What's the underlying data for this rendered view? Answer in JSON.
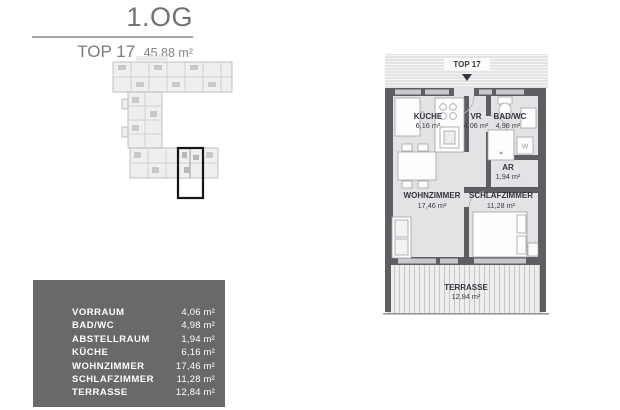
{
  "header": {
    "floor_label": "1.OG",
    "unit_label": "TOP 17",
    "total_area": "45,88 m²"
  },
  "plan": {
    "entrance_label": "TOP 17",
    "washer_label": "W",
    "rooms": {
      "kueche": {
        "name": "KÜCHE",
        "area": "6,16 m²"
      },
      "vr": {
        "name": "VR",
        "area": "4,06 m²"
      },
      "bad_wc": {
        "name": "BAD/WC",
        "area": "4,98 m²"
      },
      "ar": {
        "name": "AR",
        "area": "1,94 m²"
      },
      "wohnzimmer": {
        "name": "WOHNZIMMER",
        "area": "17,46 m²"
      },
      "schlafzimmer": {
        "name": "SCHLAFZIMMER",
        "area": "11,28 m²"
      },
      "terrasse": {
        "name": "TERRASSE",
        "area": "12,84 m²"
      }
    }
  },
  "room_table": {
    "rows": [
      {
        "label": "VORRAUM",
        "value": "4,06 m²"
      },
      {
        "label": "BAD/WC",
        "value": "4,98 m²"
      },
      {
        "label": "ABSTELLRAUM",
        "value": "1,94 m²"
      },
      {
        "label": "KÜCHE",
        "value": "6,16 m²"
      },
      {
        "label": "WOHNZIMMER",
        "value": "17,46 m²"
      },
      {
        "label": "SCHLAFZIMMER",
        "value": "11,28 m²"
      },
      {
        "label": "TERRASSE",
        "value": "12,84 m²"
      }
    ]
  },
  "colors": {
    "wall": "#5d5d62",
    "floor": "#e3e3e5",
    "plan_text": "#35353e",
    "panel_bg": "#6b6869",
    "title_text": "#727176",
    "highlight": "#141414"
  }
}
